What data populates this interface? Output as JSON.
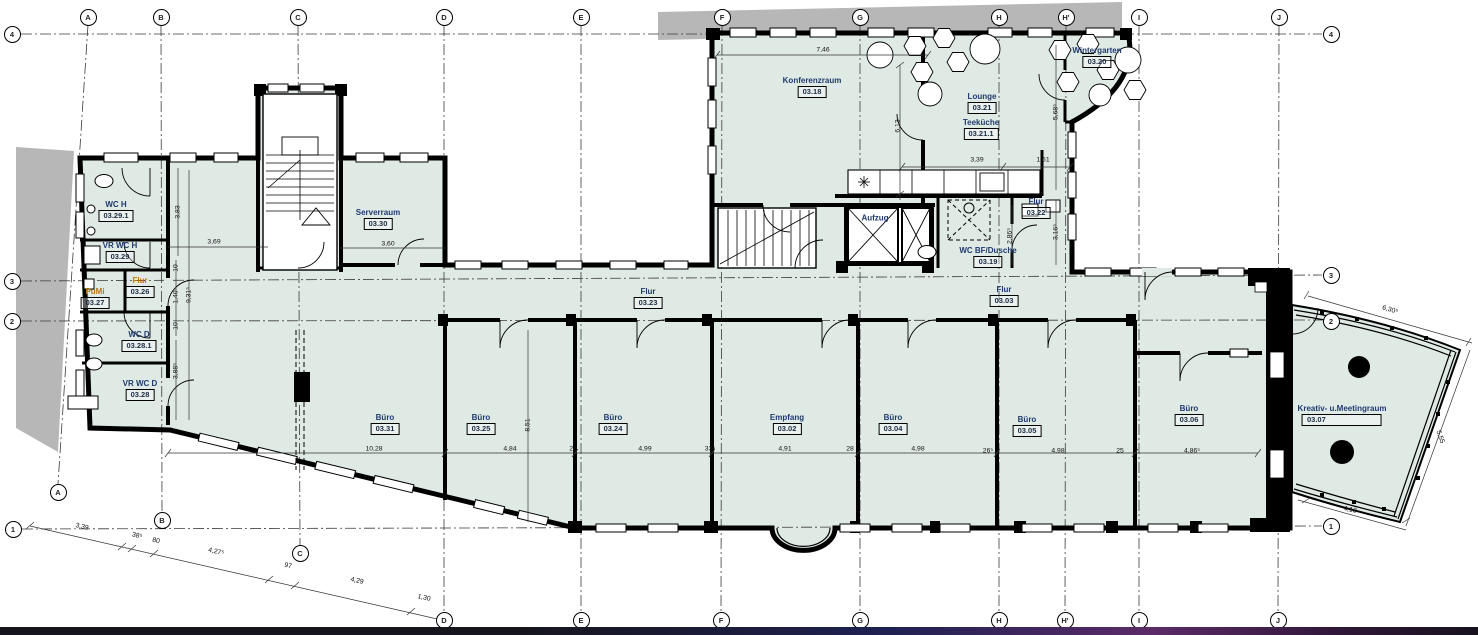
{
  "plan": {
    "colors": {
      "room_fill": "#e0eae5",
      "wall": "#000000",
      "shade_gray": "#b7b7b7",
      "label_navy": "#1e3a6e",
      "label_accent": "#b87a10",
      "taskbar_dark": "#16151d",
      "taskbar_purple": "#5c2b68"
    },
    "rooms": [
      {
        "name": "WC H",
        "number": "03.29.1"
      },
      {
        "name": "VR WC H",
        "number": "03.29"
      },
      {
        "name": "PuMi",
        "number": "03.27"
      },
      {
        "name": "Flur",
        "number": "03.26"
      },
      {
        "name": "WC D",
        "number": "03.28.1"
      },
      {
        "name": "VR WC D",
        "number": "03.28"
      },
      {
        "name": "Serverraum",
        "number": "03.30"
      },
      {
        "name": "Büro",
        "number": "03.31"
      },
      {
        "name": "Büro",
        "number": "03.25"
      },
      {
        "name": "Büro",
        "number": "03.24"
      },
      {
        "name": "Flur",
        "number": "03.23"
      },
      {
        "name": "Empfang",
        "number": "03.02"
      },
      {
        "name": "Büro",
        "number": "03.04"
      },
      {
        "name": "Büro",
        "number": "03.05"
      },
      {
        "name": "Büro",
        "number": "03.06"
      },
      {
        "name": "Flur",
        "number": "03.03"
      },
      {
        "name": "Kreativ- u.Meetingraum",
        "number": "03.07"
      },
      {
        "name": "Konferenzraum",
        "number": "03.18"
      },
      {
        "name": "Lounge",
        "number": "03.21"
      },
      {
        "name": "Teeküche",
        "number": "03.21.1"
      },
      {
        "name": "Wintergarten",
        "number": "03.20"
      },
      {
        "name": "Flur",
        "number": "03.22"
      },
      {
        "name": "WC BF/Dusche",
        "number": "03.19"
      }
    ],
    "elevator_label": "Aufzug",
    "dims": [
      "7,46",
      "6,13",
      "3,39",
      "1,51",
      "5,68⁵",
      "3,16⁵",
      "2,86⁵",
      "3,69",
      "3,60",
      "3,83",
      "9,31⁵",
      "10",
      "1,40",
      "10",
      "3,88⁵",
      "10,28",
      "4,84",
      "26",
      "4,99",
      "33⁵",
      "4,91",
      "28",
      "4,98",
      "26⁵",
      "4,98",
      "25",
      "4,86⁵",
      "8,51",
      "6,30⁵",
      "5,55",
      "4,13",
      "3,39",
      "38⁵",
      "80",
      "4,27⁵",
      "97",
      "4,29",
      "1,30"
    ],
    "grid": {
      "top": [
        "A",
        "B",
        "C",
        "D",
        "E",
        "F",
        "G",
        "H",
        "H'",
        "I",
        "J"
      ],
      "bottom": [
        "A",
        "B",
        "C",
        "D",
        "E",
        "F",
        "G",
        "H",
        "H'",
        "I",
        "J"
      ],
      "left": [
        "4",
        "3",
        "2",
        "1"
      ],
      "right": [
        "4",
        "3",
        "2",
        "1"
      ]
    }
  }
}
